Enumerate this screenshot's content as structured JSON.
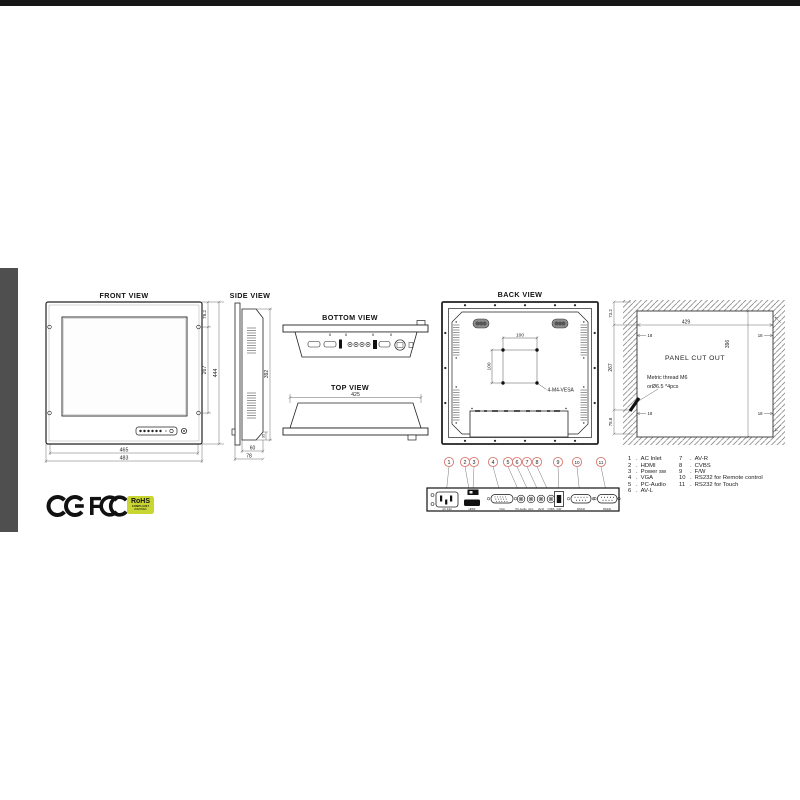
{
  "colors": {
    "accent_red": "#d97b72",
    "line": "#222222",
    "hatch": "#8a8a8a",
    "left_strip": "#4f4f4f",
    "top_bar": "#161616",
    "rohs_bg": "#c9d531"
  },
  "views": {
    "front": {
      "label": "FRONT VIEW",
      "dim_inner_width": "465",
      "dim_outer_width": "483",
      "dim_top": "78.2",
      "dim_mid": "267",
      "dim_height": "444"
    },
    "side": {
      "label": "SIDE VIEW",
      "dim_height": "392",
      "dim_depth_body": "60",
      "dim_depth_total": "78",
      "dim_chamfer": "35"
    },
    "bottom": {
      "label": "BOTTOM VIEW"
    },
    "top": {
      "label": "TOP VIEW",
      "dim_width": "425"
    },
    "back": {
      "label": "BACK VIEW",
      "vesa_w": "100",
      "vesa_h": "100",
      "vesa_label": "4-M4-VESA"
    },
    "cutout": {
      "label": "PANEL CUT OUT",
      "dim_width": "429",
      "dim_height": "396",
      "dim_left_top": "73.2",
      "dim_left_mid": "267",
      "dim_left_bottom": "75.8",
      "corner_offset": "18",
      "note1": "Metric thread M6",
      "note2": "orØ6.5 *4pcs"
    }
  },
  "connectors": {
    "numbers": [
      "1",
      "2",
      "3",
      "4",
      "5",
      "6",
      "7",
      "8",
      "9",
      "10",
      "11"
    ],
    "port_labels": [
      "AC Inlet",
      "HDMI",
      "VGA",
      "PC-Audio",
      "AV-L",
      "AV-R",
      "CVBS",
      "F/W",
      "RS232",
      "RS232"
    ]
  },
  "legend": {
    "sep": ".",
    "col1": [
      {
        "n": "1",
        "label": "AC Inlet"
      },
      {
        "n": "2",
        "label": "HDMI"
      },
      {
        "n": "3",
        "label": "Power sw"
      },
      {
        "n": "4",
        "label": "VGA"
      },
      {
        "n": "5",
        "label": "PC-Audio"
      },
      {
        "n": "6",
        "label": "AV-L"
      }
    ],
    "col2": [
      {
        "n": "7",
        "label": "AV-R"
      },
      {
        "n": "8",
        "label": "CVBS"
      },
      {
        "n": "9",
        "label": "F/W"
      },
      {
        "n": "10",
        "label": "RS232 for Remote control"
      },
      {
        "n": "11",
        "label": "RS232 for Touch"
      }
    ]
  },
  "logos": {
    "rohs": "RoHS",
    "rohs_sub1": "COMPLIANT",
    "rohs_sub2": "2002/95/EC"
  }
}
